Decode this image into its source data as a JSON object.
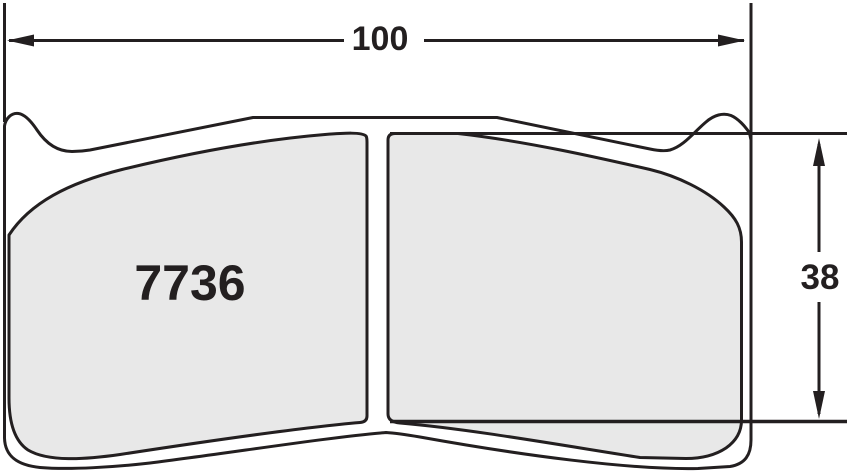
{
  "drawing": {
    "title": "brake-pad-dimensional-drawing",
    "part_number": "7736",
    "dimensions": {
      "width": {
        "label": "100"
      },
      "height": {
        "label": "38"
      }
    },
    "colors": {
      "outline": "#231f20",
      "pad_fill": "#e8e8e8",
      "background": "#ffffff"
    }
  }
}
